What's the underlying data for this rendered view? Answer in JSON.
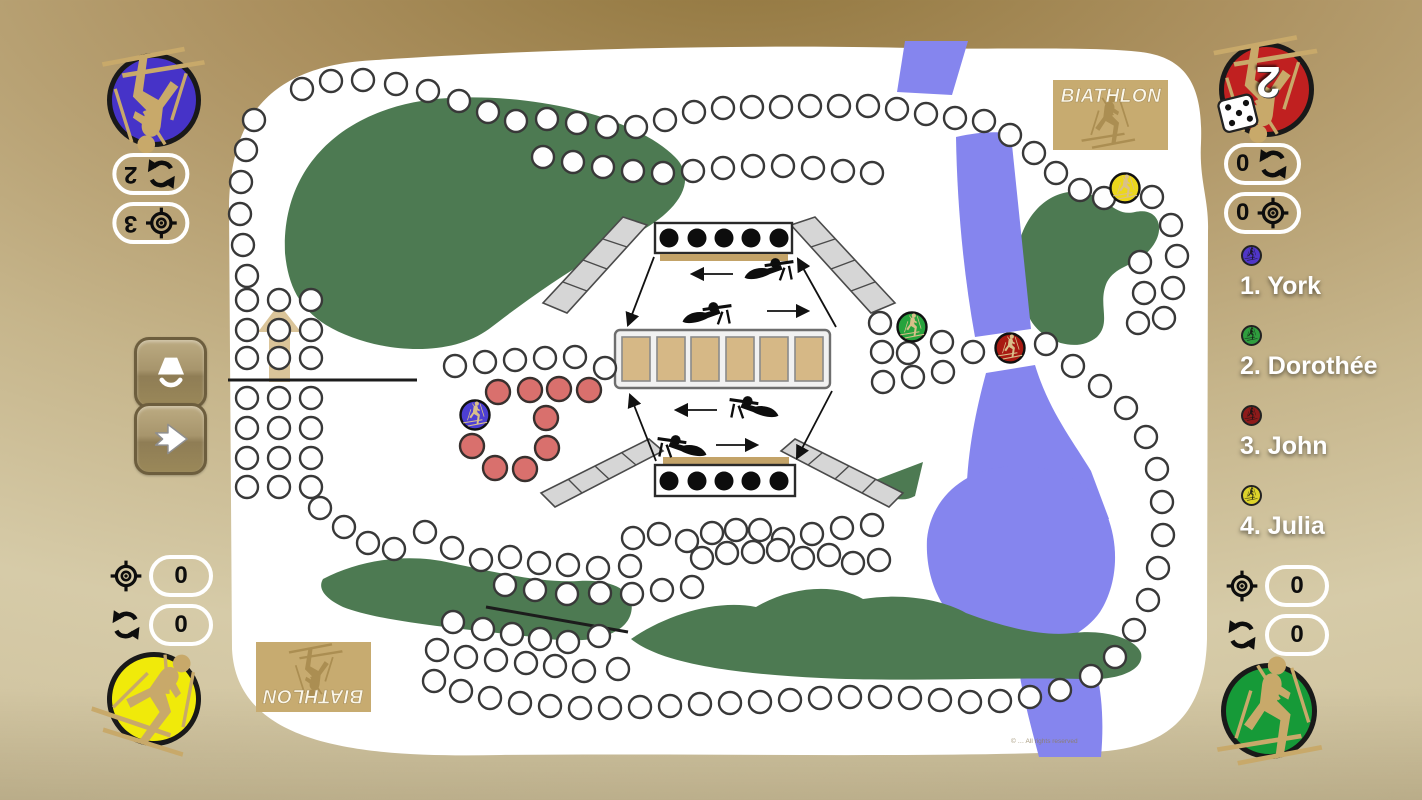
{
  "app": {
    "logo_text": "BIATHLON",
    "copyright": "© … All rights reserved"
  },
  "players": [
    {
      "label": "1. York",
      "color": "#5036c8"
    },
    {
      "label": "2. Dorothée",
      "color": "#2f9e3e"
    },
    {
      "label": "3. John",
      "color": "#8e1a1a"
    },
    {
      "label": "4. Julia",
      "color": "#ddd32a"
    }
  ],
  "corner_panels": {
    "top_left": {
      "player": "York",
      "circle_color": "#4633c8",
      "rows": [
        {
          "icon": "refresh",
          "value": "2"
        },
        {
          "icon": "target",
          "value": "3"
        }
      ]
    },
    "top_right": {
      "player": "John",
      "circle_color": "#c02020",
      "dice_value": "2",
      "rows": [
        {
          "icon": "refresh",
          "value": "0"
        },
        {
          "icon": "target",
          "value": "0"
        }
      ]
    },
    "bottom_left": {
      "player": "Julia",
      "circle_color": "#f0ea0a",
      "rows": [
        {
          "icon": "target",
          "value": "0"
        },
        {
          "icon": "refresh",
          "value": "0"
        }
      ]
    },
    "bottom_right": {
      "player": "Dorothée",
      "circle_color": "#169a38",
      "rows": [
        {
          "icon": "target",
          "value": "0"
        },
        {
          "icon": "refresh",
          "value": "0"
        }
      ]
    }
  },
  "side_buttons": [
    {
      "icon": "lamp"
    },
    {
      "icon": "arrow-right"
    }
  ],
  "board": {
    "range": {
      "targets_per_bank": 5,
      "shooting_mats": 6
    },
    "tokens": [
      {
        "player": "York",
        "color": "#4d3fd4",
        "x": 264,
        "y": 374
      },
      {
        "player": "Dorothée",
        "color": "#27a33d",
        "x": 701,
        "y": 286
      },
      {
        "player": "John",
        "color": "#a81a12",
        "x": 799,
        "y": 307
      },
      {
        "player": "Julia",
        "color": "#ecd71c",
        "x": 914,
        "y": 147
      }
    ],
    "penalty_loop": [
      [
        287,
        351
      ],
      [
        319,
        349
      ],
      [
        348,
        348
      ],
      [
        378,
        349
      ],
      [
        335,
        377
      ],
      [
        336,
        407
      ],
      [
        261,
        405
      ],
      [
        284,
        427
      ],
      [
        314,
        428
      ]
    ],
    "start_grid": {
      "cols": [
        36,
        68,
        100
      ],
      "rows": [
        259,
        289,
        317,
        357,
        387,
        417,
        446
      ]
    },
    "track_segments": [
      [
        [
          91,
          48
        ],
        [
          120,
          40
        ],
        [
          152,
          39
        ],
        [
          185,
          43
        ],
        [
          217,
          50
        ],
        [
          248,
          60
        ],
        [
          277,
          71
        ],
        [
          305,
          80
        ]
      ],
      [
        [
          336,
          78
        ],
        [
          366,
          82
        ],
        [
          396,
          86
        ],
        [
          425,
          86
        ],
        [
          454,
          79
        ],
        [
          483,
          71
        ],
        [
          512,
          67
        ],
        [
          541,
          66
        ],
        [
          570,
          66
        ],
        [
          599,
          65
        ],
        [
          628,
          65
        ],
        [
          657,
          65
        ],
        [
          686,
          68
        ],
        [
          715,
          73
        ],
        [
          744,
          77
        ],
        [
          773,
          80
        ]
      ],
      [
        [
          332,
          116
        ],
        [
          362,
          121
        ],
        [
          392,
          126
        ],
        [
          422,
          130
        ],
        [
          452,
          132
        ],
        [
          482,
          130
        ],
        [
          512,
          127
        ],
        [
          542,
          125
        ],
        [
          572,
          125
        ],
        [
          602,
          127
        ],
        [
          632,
          130
        ],
        [
          661,
          132
        ]
      ],
      [
        [
          799,
          94
        ],
        [
          823,
          112
        ],
        [
          845,
          132
        ],
        [
          869,
          149
        ],
        [
          893,
          157
        ],
        [
          941,
          156
        ],
        [
          960,
          184
        ],
        [
          966,
          215
        ],
        [
          962,
          247
        ],
        [
          953,
          277
        ]
      ],
      [
        [
          929,
          221
        ],
        [
          933,
          252
        ],
        [
          927,
          282
        ]
      ],
      [
        [
          669,
          282
        ],
        [
          671,
          311
        ],
        [
          672,
          341
        ],
        [
          697,
          312
        ],
        [
          702,
          336
        ],
        [
          731,
          301
        ],
        [
          732,
          331
        ],
        [
          762,
          311
        ],
        [
          835,
          303
        ]
      ],
      [
        [
          862,
          325
        ],
        [
          889,
          345
        ],
        [
          915,
          367
        ],
        [
          935,
          396
        ],
        [
          946,
          428
        ],
        [
          951,
          461
        ],
        [
          952,
          494
        ],
        [
          947,
          527
        ],
        [
          937,
          559
        ],
        [
          923,
          589
        ],
        [
          904,
          616
        ],
        [
          880,
          635
        ]
      ],
      [
        [
          849,
          649
        ],
        [
          819,
          656
        ],
        [
          789,
          660
        ],
        [
          759,
          661
        ],
        [
          729,
          659
        ],
        [
          699,
          657
        ],
        [
          669,
          656
        ],
        [
          639,
          656
        ],
        [
          609,
          657
        ],
        [
          579,
          659
        ],
        [
          549,
          661
        ],
        [
          519,
          662
        ],
        [
          489,
          663
        ],
        [
          459,
          665
        ],
        [
          429,
          666
        ],
        [
          399,
          667
        ],
        [
          369,
          667
        ],
        [
          339,
          665
        ],
        [
          309,
          662
        ],
        [
          279,
          657
        ],
        [
          250,
          650
        ],
        [
          223,
          640
        ]
      ],
      [
        [
          214,
          491
        ],
        [
          241,
          507
        ],
        [
          270,
          519
        ],
        [
          299,
          516
        ],
        [
          328,
          522
        ],
        [
          357,
          524
        ],
        [
          387,
          527
        ],
        [
          419,
          525
        ]
      ],
      [
        [
          422,
          497
        ],
        [
          448,
          493
        ],
        [
          476,
          500
        ],
        [
          501,
          492
        ],
        [
          525,
          489
        ],
        [
          549,
          489
        ],
        [
          572,
          498
        ],
        [
          601,
          493
        ],
        [
          631,
          487
        ],
        [
          661,
          484
        ]
      ],
      [
        [
          491,
          517
        ],
        [
          516,
          512
        ],
        [
          542,
          511
        ],
        [
          567,
          509
        ],
        [
          592,
          517
        ],
        [
          618,
          514
        ],
        [
          642,
          522
        ],
        [
          668,
          519
        ]
      ],
      [
        [
          294,
          544
        ],
        [
          324,
          549
        ],
        [
          356,
          553
        ],
        [
          389,
          552
        ],
        [
          421,
          553
        ],
        [
          451,
          549
        ],
        [
          481,
          546
        ]
      ],
      [
        [
          242,
          581
        ],
        [
          272,
          588
        ],
        [
          301,
          593
        ],
        [
          329,
          598
        ],
        [
          357,
          601
        ],
        [
          388,
          595
        ]
      ],
      [
        [
          226,
          609
        ],
        [
          255,
          616
        ],
        [
          285,
          619
        ],
        [
          315,
          622
        ],
        [
          344,
          625
        ],
        [
          373,
          630
        ],
        [
          407,
          628
        ]
      ],
      [
        [
          43,
          79
        ],
        [
          35,
          109
        ],
        [
          30,
          141
        ],
        [
          29,
          173
        ],
        [
          32,
          204
        ],
        [
          36,
          235
        ]
      ],
      [
        [
          244,
          325
        ],
        [
          274,
          321
        ],
        [
          304,
          319
        ],
        [
          334,
          317
        ],
        [
          364,
          316
        ],
        [
          394,
          327
        ]
      ],
      [
        [
          109,
          467
        ],
        [
          133,
          486
        ],
        [
          157,
          502
        ],
        [
          183,
          508
        ]
      ]
    ]
  }
}
